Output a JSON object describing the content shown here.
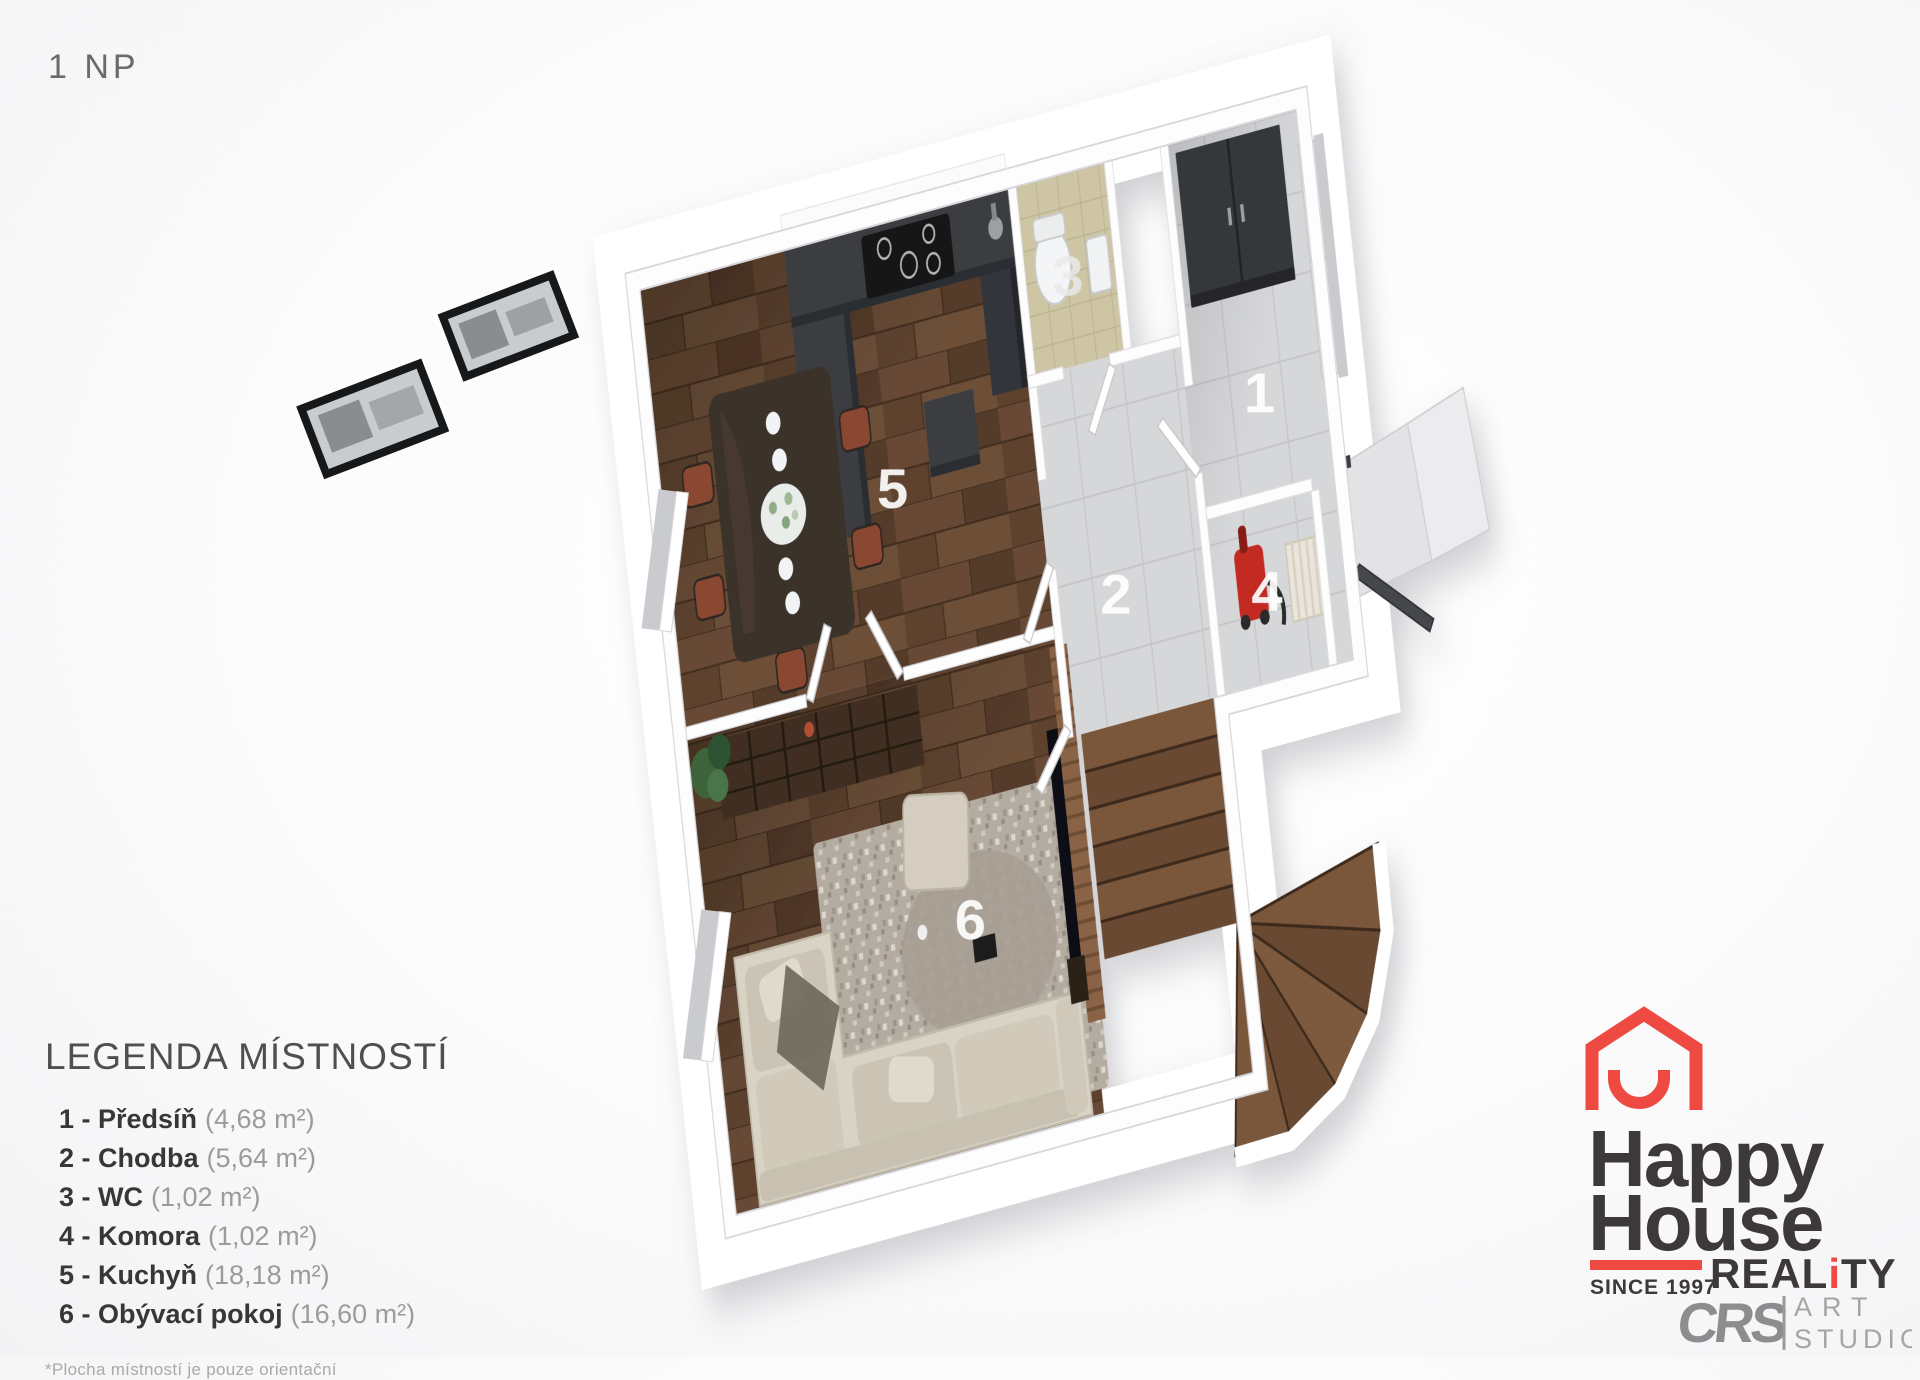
{
  "page": {
    "floor_label": "1 NP"
  },
  "plan": {
    "labels": [
      {
        "text": "1"
      },
      {
        "text": "2"
      },
      {
        "text": "3"
      },
      {
        "text": "4"
      },
      {
        "text": "5"
      },
      {
        "text": "6"
      }
    ]
  },
  "legend": {
    "title": "LEGENDA MÍSTNOSTÍ",
    "rooms": [
      {
        "label": "1 - Předsíň",
        "area": "(4,68 m²)"
      },
      {
        "label": "2 - Chodba",
        "area": "(5,64 m²)"
      },
      {
        "label": "3 - WC",
        "area": "(1,02 m²)"
      },
      {
        "label": "4 - Komora",
        "area": "(1,02 m²)"
      },
      {
        "label": "5 - Kuchyň",
        "area": "(18,18 m²)"
      },
      {
        "label": "6 - Obývací pokoj",
        "area": "(16,60 m²)"
      }
    ],
    "footnote": "*Plocha místností je pouze orientační"
  },
  "logo": {
    "word1": "Happy",
    "word2": "House",
    "since": "SINCE 1997",
    "reality_pre": "REAL",
    "reality_i": "i",
    "reality_post": "TY",
    "crs": "CRS",
    "art": "ART",
    "studio": "STUDIO"
  },
  "colors": {
    "accent_red": "#ef4a42",
    "logo_dark": "#3d3939",
    "crs_gray": "#8d8d8f",
    "wood_floor": "#5c4230",
    "tile_floor": "#d6d7d9",
    "counter_dark": "#3a3e41",
    "sofa_beige": "#d9d3c6"
  }
}
